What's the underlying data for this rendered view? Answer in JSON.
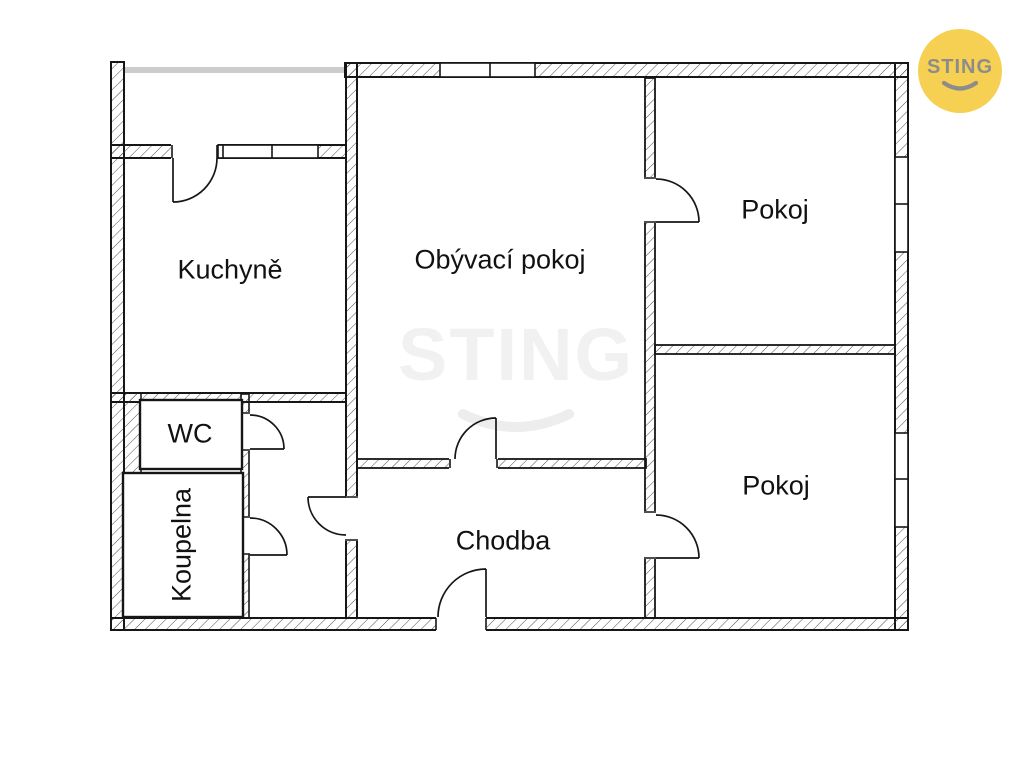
{
  "rooms": [
    {
      "id": "kuchyne",
      "label": "Kuchyně"
    },
    {
      "id": "obyvaci-pokoj",
      "label": "Obývací pokoj"
    },
    {
      "id": "pokoj-top",
      "label": "Pokoj"
    },
    {
      "id": "pokoj-bottom",
      "label": "Pokoj"
    },
    {
      "id": "chodba",
      "label": "Chodba"
    },
    {
      "id": "wc",
      "label": "WC"
    },
    {
      "id": "koupelna",
      "label": "Koupelna"
    }
  ],
  "watermark": {
    "text": "STING"
  },
  "logo": {
    "text": "STING"
  },
  "colors": {
    "wall_line": "#161616",
    "hatch_line": "#3c3c3c",
    "balcony_edge_gray": "#cccccc",
    "watermark_gray": "#f1f1f1",
    "watermark_smile_gray": "#ededed",
    "logo_yellow": "#f6d052",
    "logo_text_gray": "#8c8c8c"
  }
}
